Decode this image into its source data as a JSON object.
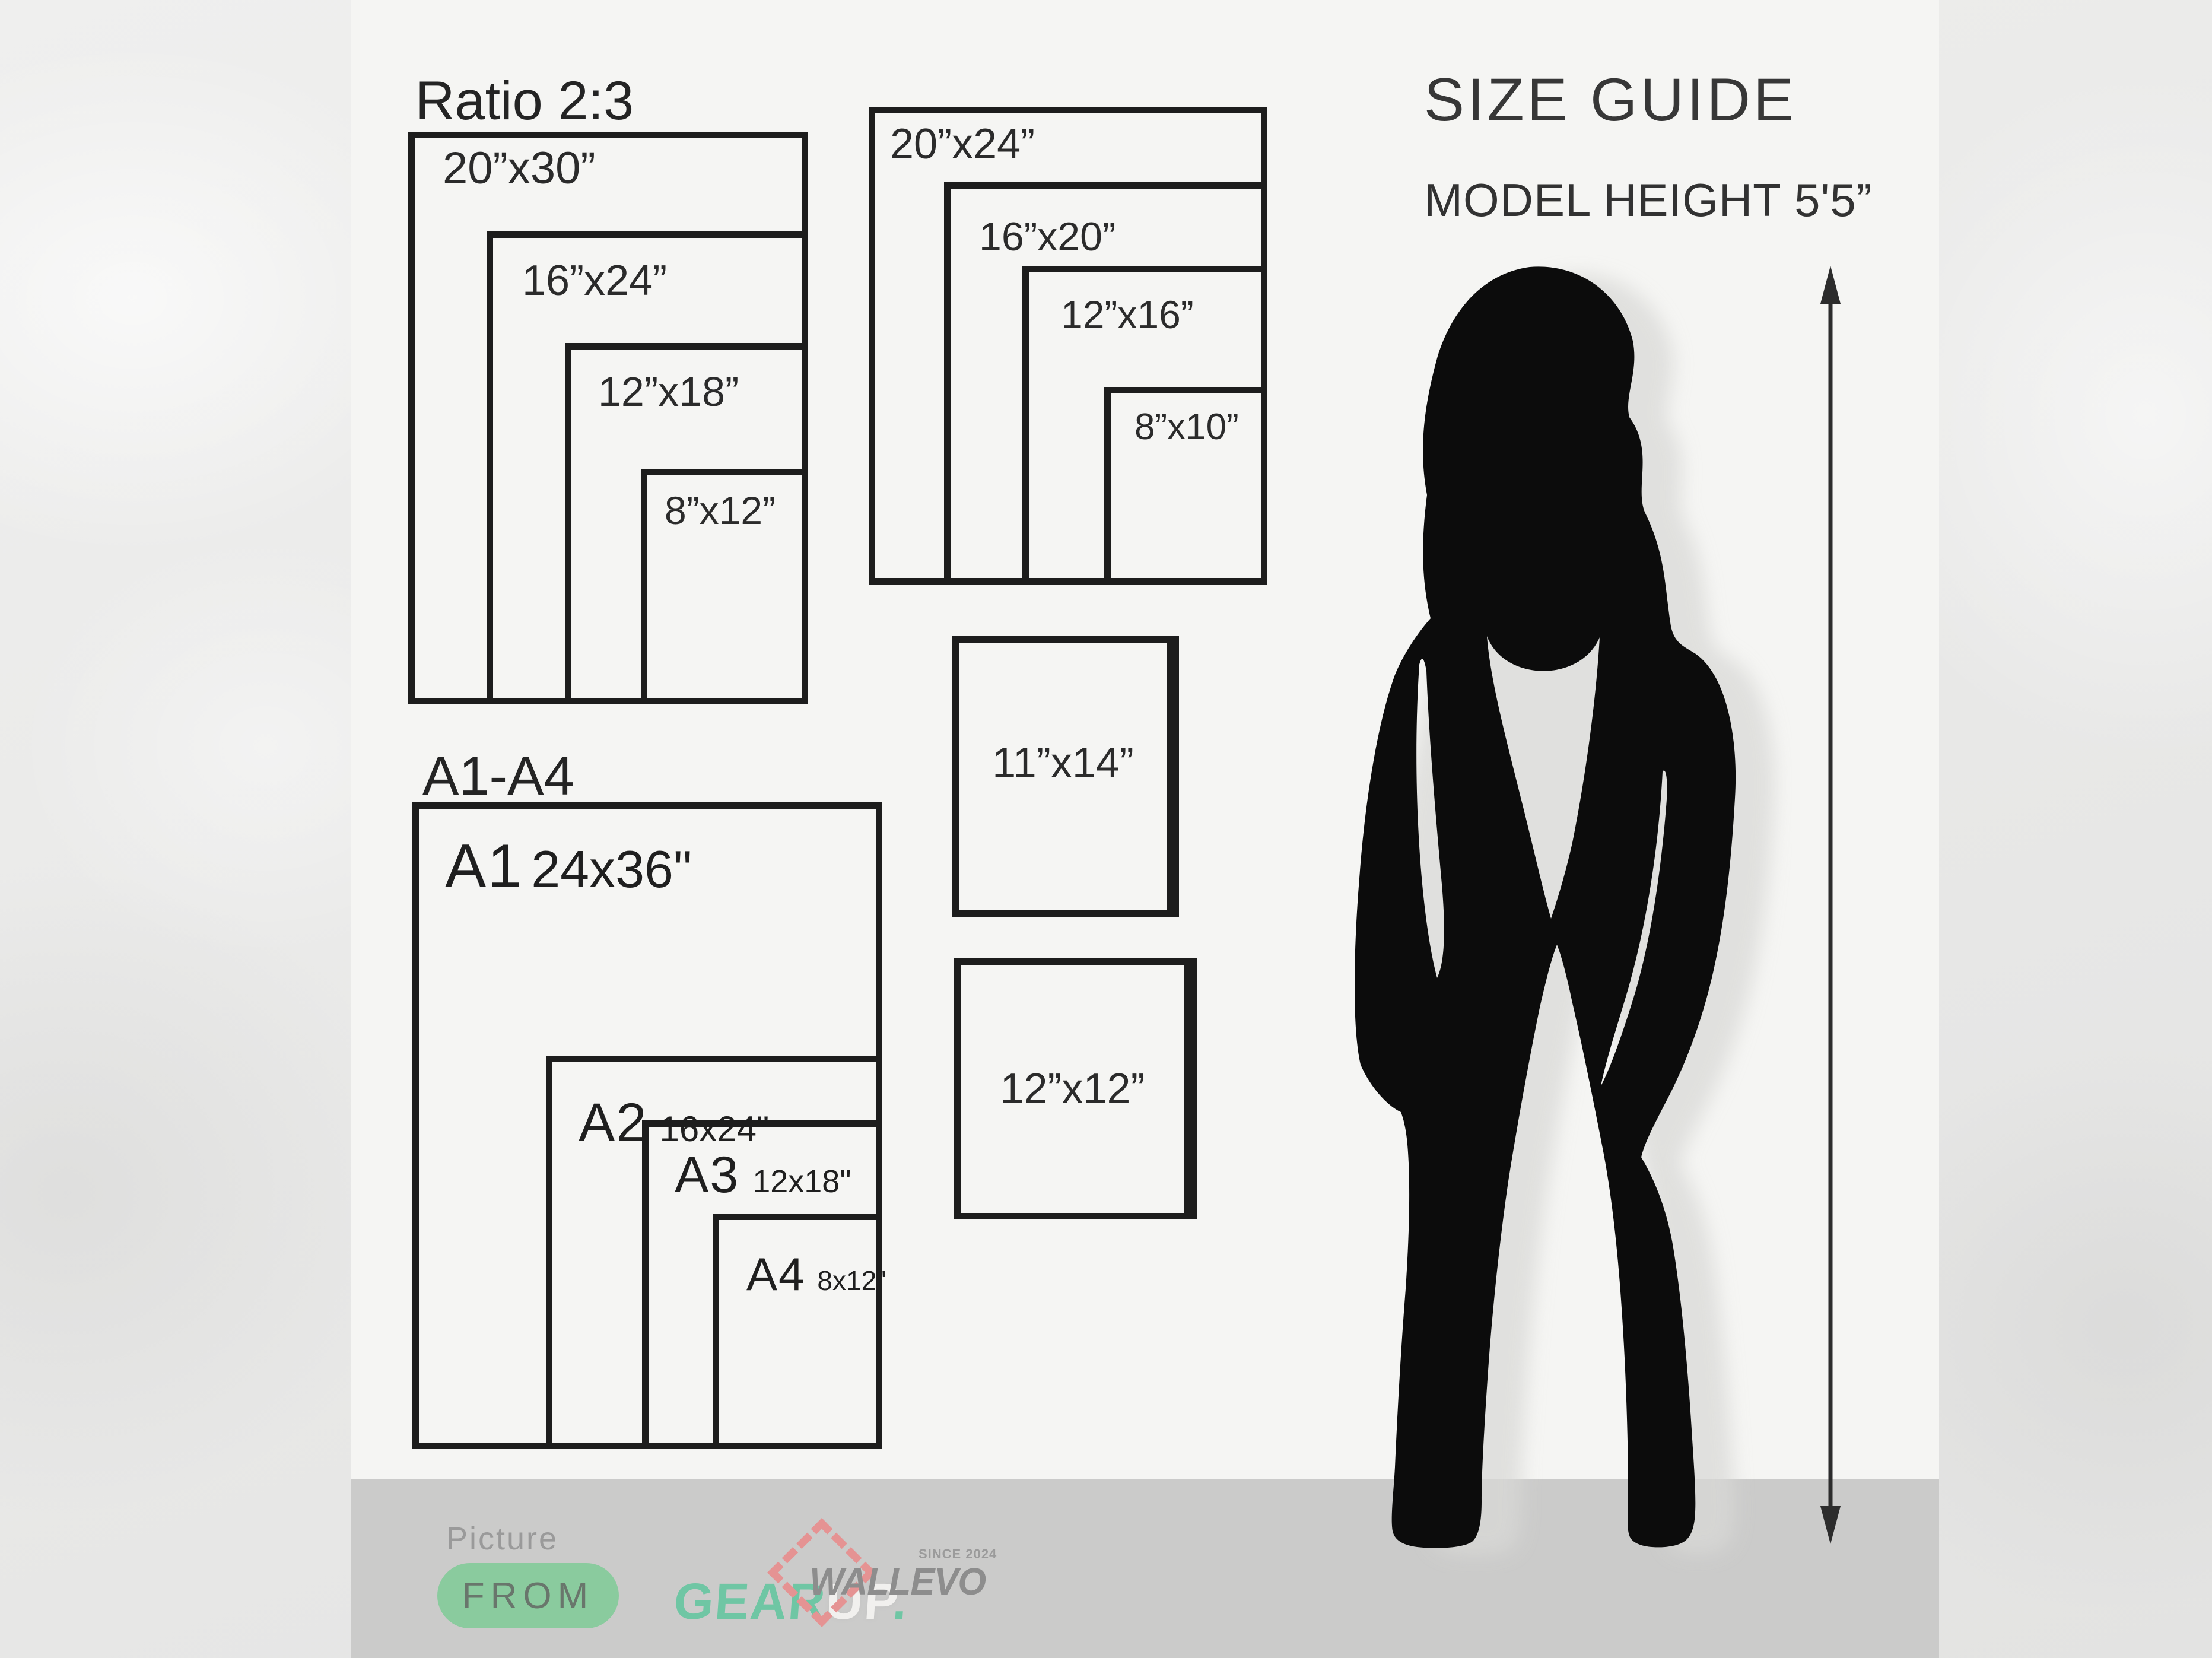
{
  "header": {
    "title": "SIZE GUIDE",
    "model_height": "MODEL HEIGHT 5'5”"
  },
  "ratio_group": {
    "title": "Ratio 2:3",
    "sizes": [
      "20”x30”",
      "16”x24”",
      "12”x18”",
      "8”x12”"
    ]
  },
  "standard_group": {
    "sizes": [
      "20”x24”",
      "16”x20”",
      "12”x16”",
      "8”x10”"
    ]
  },
  "a_group": {
    "title": "A1-A4",
    "items": [
      {
        "code": "A1",
        "size": "24x36\""
      },
      {
        "code": "A2",
        "size": "16x24\""
      },
      {
        "code": "A3",
        "size": "12x18\""
      },
      {
        "code": "A4",
        "size": "8x12\""
      }
    ]
  },
  "single_boxes": [
    {
      "size": "11”x14”"
    },
    {
      "size": "12”x12”"
    }
  ],
  "footer": {
    "picture_label": "Picture",
    "from_label": "FROM",
    "gear": "GEAR",
    "up": "UP",
    "dot": ".",
    "brand": "WALLEVO",
    "since": "SINCE 2024"
  },
  "colors": {
    "panel": "#f5f5f3",
    "band": "#cbcbca",
    "rect_border": "#1d1d1d",
    "accent_green": "#8acb9e",
    "accent_teal": "#6fc6a4",
    "brand_pink": "#e59393",
    "brand_gray": "#8d8d8d"
  }
}
